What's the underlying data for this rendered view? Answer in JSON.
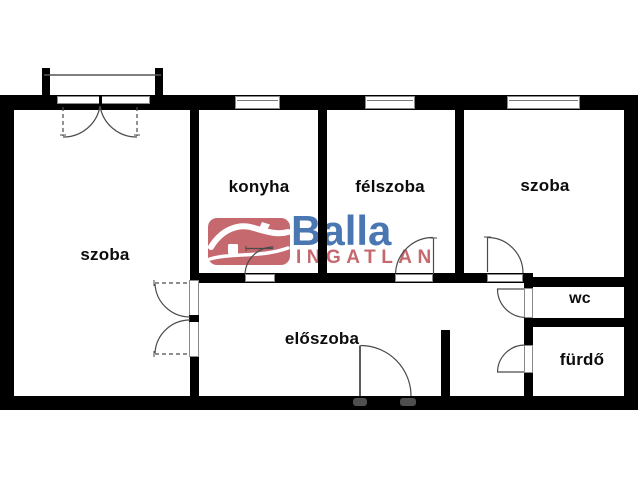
{
  "plan": {
    "background": "#ffffff",
    "wall_color": "#000000",
    "door_line_color": "#4a4a4a",
    "rooms": [
      {
        "id": "szoba-left",
        "label": "szoba"
      },
      {
        "id": "konyha",
        "label": "konyha"
      },
      {
        "id": "felszoba",
        "label": "félszoba"
      },
      {
        "id": "szoba-right",
        "label": "szoba"
      },
      {
        "id": "eloszoba",
        "label": "előszoba"
      },
      {
        "id": "wc",
        "label": "wc"
      },
      {
        "id": "furdo",
        "label": "fürdő"
      }
    ]
  },
  "logo": {
    "brand": "Balla",
    "tagline": "INGATLAN",
    "brand_color": "#4a77b1",
    "tagline_color": "#c5696f",
    "icon": "house-icon"
  }
}
